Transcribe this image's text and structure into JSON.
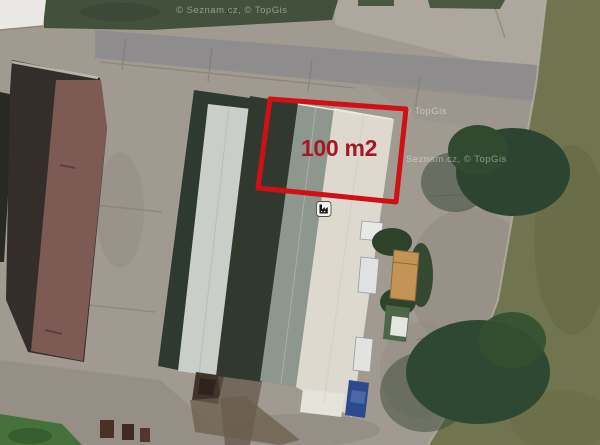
{
  "map": {
    "provider_watermark_top": "© Seznam.cz, © TopGis",
    "provider_watermark_right_upper": "© TopGis",
    "provider_watermark_right_lower": "Seznam.cz, © TopGis"
  },
  "annotation": {
    "area_label": "100 m2",
    "outline_color": "#cf1016",
    "label_color": "#a51723"
  },
  "marker": {
    "icon": "factory-icon",
    "glyph_color": "#1a1a1a",
    "background_color": "#f5f4f1"
  },
  "scene": {
    "description_colors": {
      "concrete": "#a19a91",
      "asphalt": "#8c8b8d",
      "grass_dark": "#43503b",
      "grass_olive": "#70744f",
      "tree": "#2d4430",
      "roof_maroon": "#7d5a53",
      "roof_dark": "#352d29",
      "roof_light": "#cacec8",
      "roof_graygreen": "#8e978e",
      "roof_white": "#ddd9cf"
    }
  }
}
